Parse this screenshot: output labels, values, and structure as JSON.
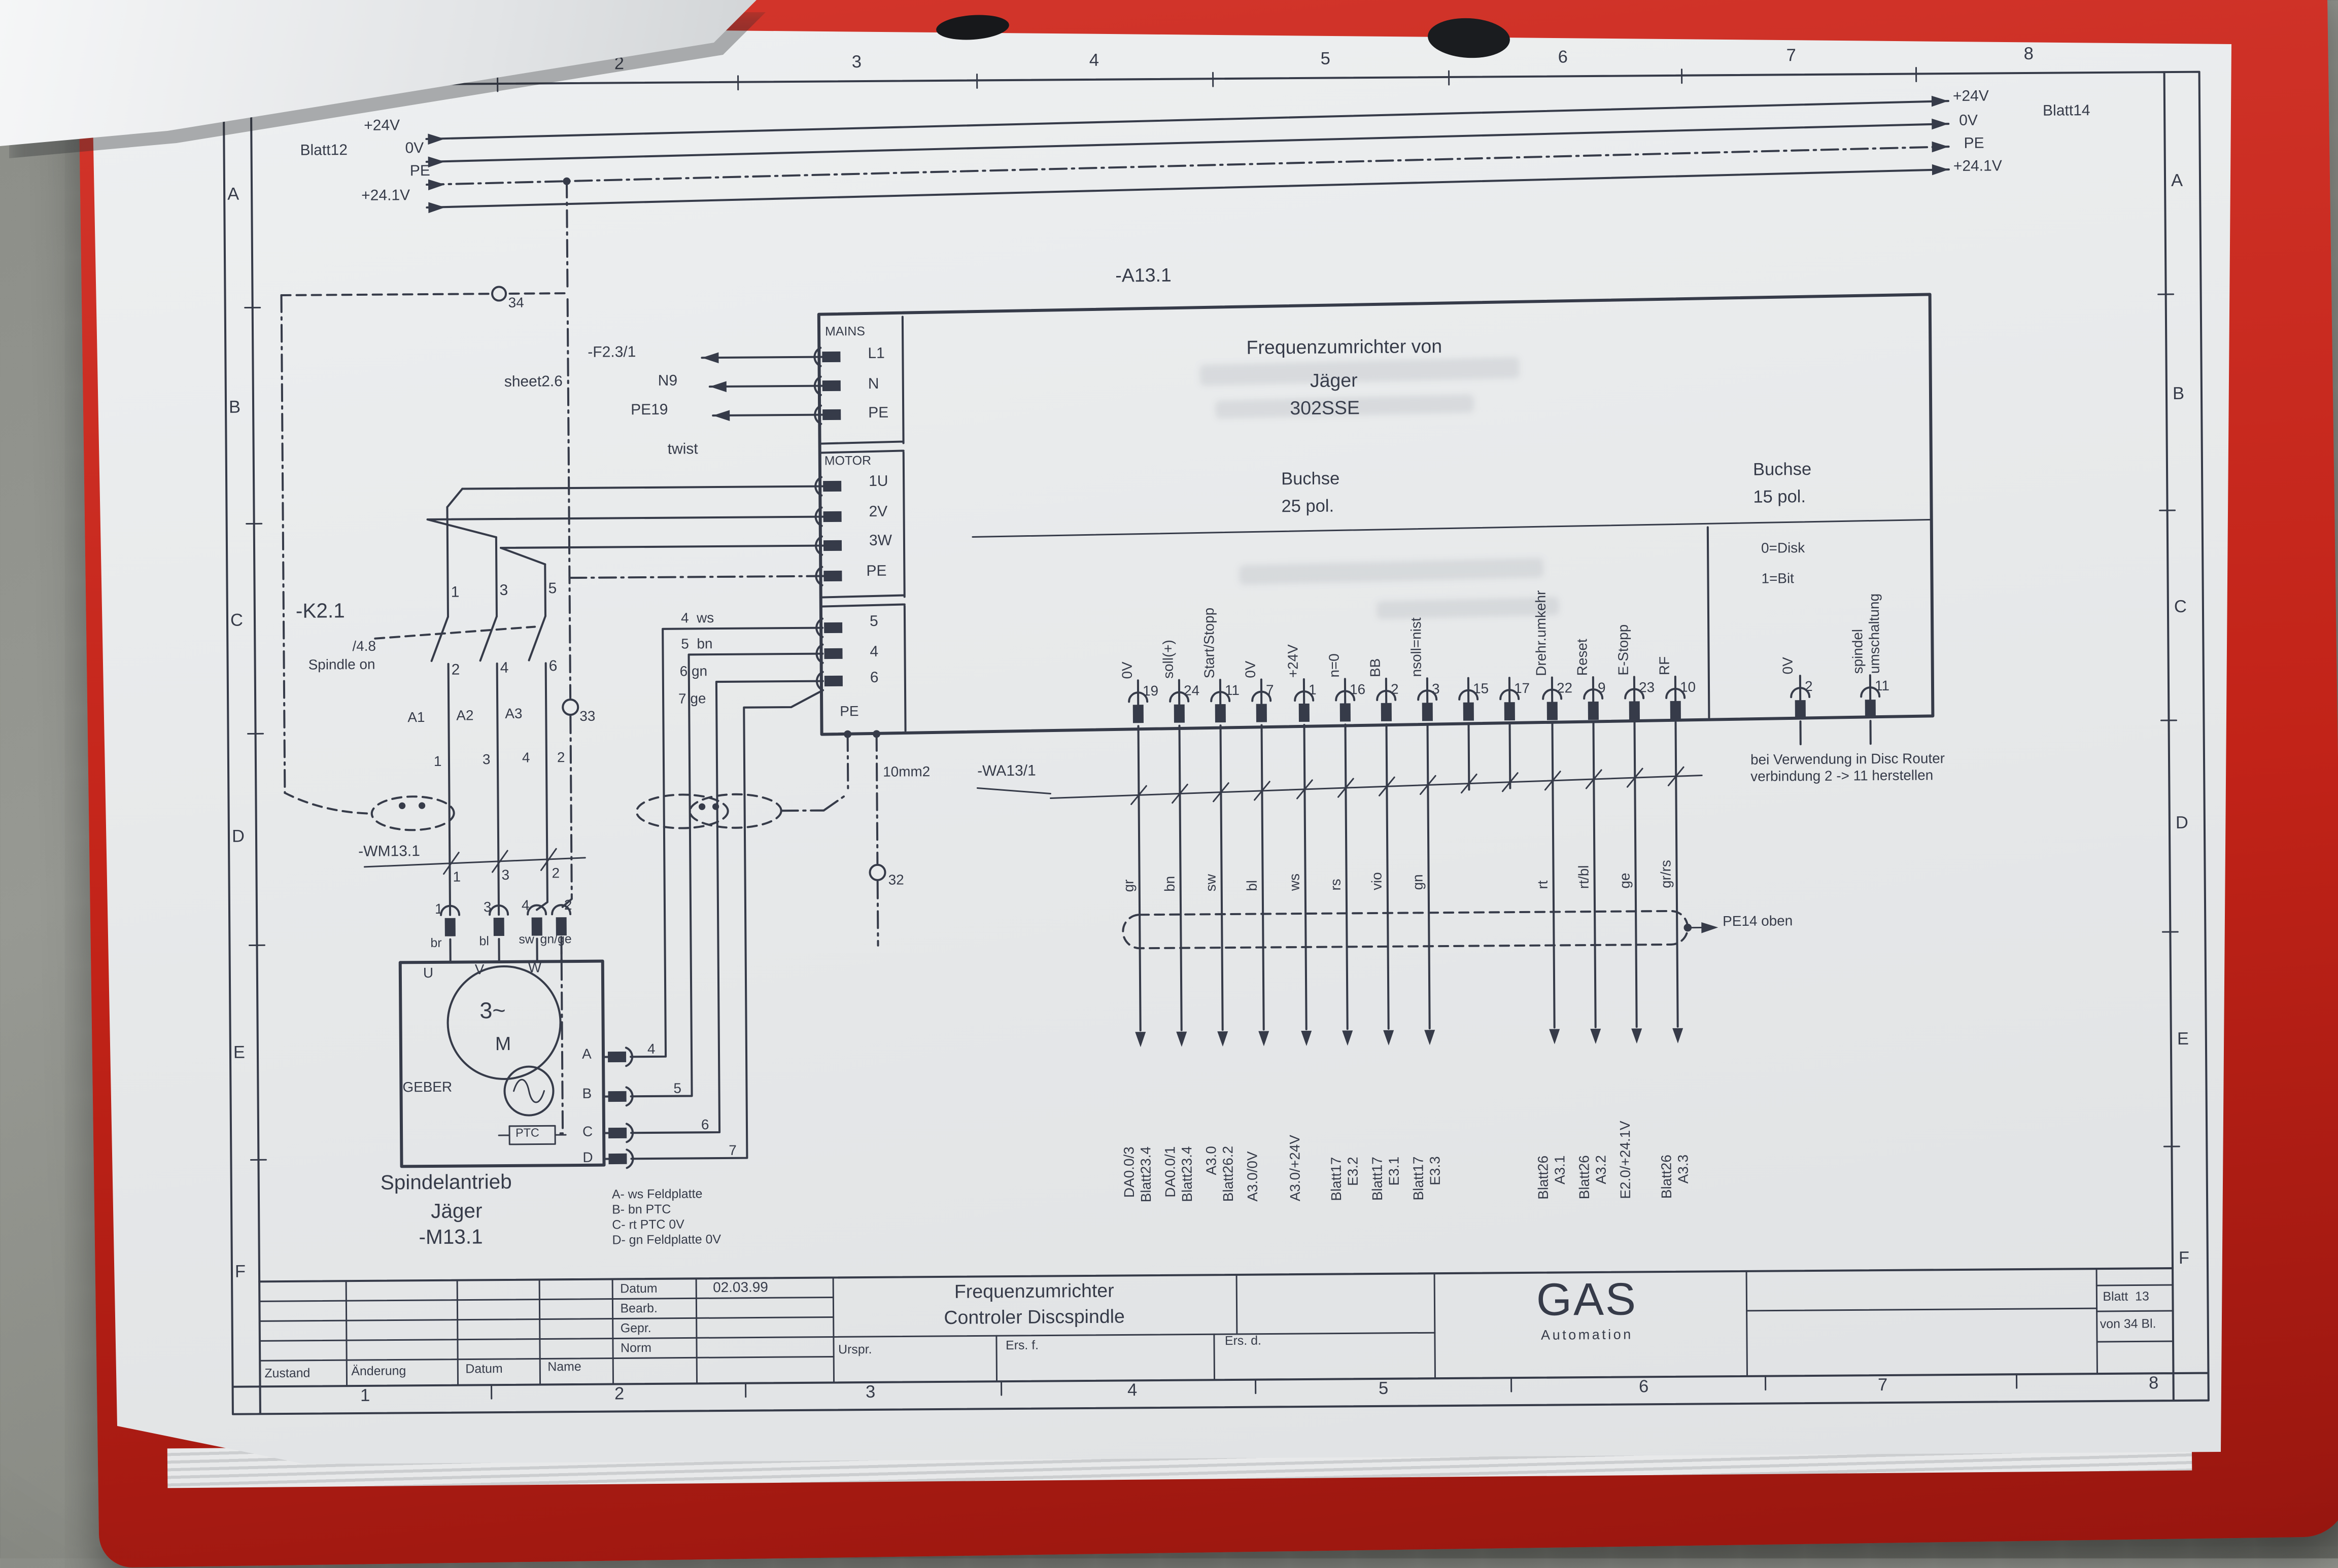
{
  "refs": {
    "left": "Blatt12",
    "right": "Blatt14",
    "rails": [
      "+24V",
      "0V",
      "PE",
      "+24.1V"
    ]
  },
  "incoming": {
    "fuse": "-F2.3/1",
    "sheet": "sheet2.6",
    "n": "N9",
    "pe": "PE19",
    "twist": "twist"
  },
  "device": {
    "tag": "-A13.1",
    "title1": "Frequenzumrichter von",
    "title2": "Jäger",
    "title3": "302SSE",
    "mains": "MAINS",
    "mains_pins": [
      "L1",
      "N",
      "PE"
    ],
    "motor": "MOTOR",
    "motor_pins": [
      "1U",
      "2V",
      "3W",
      "PE"
    ],
    "geber_pins": [
      "5",
      "4",
      "6"
    ],
    "pe": "PE",
    "con25_1": "Buchse",
    "con25_2": "25 pol.",
    "con15_1": "Buchse",
    "con15_2": "15 pol.",
    "disk": "0=Disk",
    "bit": "1=Bit"
  },
  "pins25": [
    {
      "pin": "19",
      "signal": "0V",
      "wire": "gr",
      "dest": [
        "DA0.0/3",
        "Blatt23.4"
      ]
    },
    {
      "pin": "24",
      "signal": "soll(+)",
      "wire": "bn",
      "dest": [
        "DA0.0/1",
        "Blatt23.4"
      ]
    },
    {
      "pin": "11",
      "signal": "Start/Stopp",
      "wire": "sw",
      "dest": [
        "A3.0",
        "Blatt26.2"
      ]
    },
    {
      "pin": "7",
      "signal": "0V",
      "wire": "bl",
      "dest": [
        "A3.0/0V"
      ]
    },
    {
      "pin": "1",
      "signal": "+24V",
      "wire": "ws",
      "dest": [
        "A3.0/+24V"
      ]
    },
    {
      "pin": "16",
      "signal": "n=0",
      "wire": "rs",
      "dest": [
        "Blatt17",
        "E3.2"
      ]
    },
    {
      "pin": "2",
      "signal": "BB",
      "wire": "vio",
      "dest": [
        "Blatt17",
        "E3.1"
      ]
    },
    {
      "pin": "3",
      "signal": "nsoll=nist",
      "wire": "gn",
      "dest": [
        "Blatt17",
        "E3.3"
      ]
    },
    {
      "pin": "15"
    },
    {
      "pin": "17"
    },
    {
      "pin": "22",
      "signal": "Drehr.umkehr",
      "wire": "rt",
      "dest": [
        "Blatt26",
        "A3.1"
      ]
    },
    {
      "pin": "9",
      "signal": "Reset",
      "wire": "rt/bl",
      "dest": [
        "Blatt26",
        "A3.2"
      ]
    },
    {
      "pin": "23",
      "signal": "E-Stopp",
      "wire": "ge",
      "dest": [
        "E2.0/+24.1V"
      ]
    },
    {
      "pin": "10",
      "signal": "RF",
      "wire": "gr/rs",
      "dest": [
        "Blatt26",
        "A3.3"
      ]
    }
  ],
  "pins15": [
    {
      "pin": "2",
      "signal": [
        "0V"
      ]
    },
    {
      "pin": "11",
      "signal": [
        "spindel",
        "umschaltung"
      ]
    }
  ],
  "cable25": {
    "tag": "-WA13/1",
    "pe14": "PE14 oben",
    "note1": "bei Verwendung in Disc Router",
    "note2": "verbindung 2 -> 11 herstellen"
  },
  "contactor": {
    "tag": "-K2.1",
    "ref": "/4.8",
    "func": "Spindle on",
    "top": [
      "1",
      "3",
      "5"
    ],
    "bot": [
      "2",
      "4",
      "6"
    ],
    "coil": [
      "A1",
      "A2",
      "A3"
    ],
    "wires": [
      "1",
      "3",
      "4",
      "2"
    ],
    "m33": "33",
    "m34": "34",
    "m32": "32",
    "size": "10mm2"
  },
  "cablem": {
    "tag": "-WM13.1",
    "cores": [
      "1",
      "3",
      "2"
    ],
    "pins": [
      "1",
      "3",
      "4",
      "2"
    ],
    "colors": [
      "br",
      "bl",
      "sw",
      "gn/ge"
    ]
  },
  "motor": {
    "u": "U",
    "v": "V",
    "w": "W",
    "sym": "3~",
    "m": "M",
    "geber": "GEBER",
    "ptc": "PTC",
    "pins": [
      "A",
      "B",
      "C",
      "D"
    ],
    "wire_nums": [
      "4",
      "5",
      "6",
      "7"
    ],
    "wire_rows": [
      "4  ws",
      "5  bn",
      "6 gn",
      "7 ge"
    ],
    "name1": "Spindelantrieb",
    "name2": "Jäger",
    "name3": "-M13.1",
    "legend": [
      "A- ws Feldplatte",
      "B- bn PTC",
      "C- rt PTC 0V",
      "D- gn Feldplatte 0V"
    ]
  },
  "titleblock": {
    "datum_l": "Datum",
    "datum_v": "02.03.99",
    "bearb": "Bearb.",
    "gepr": "Gepr.",
    "norm": "Norm",
    "zustand": "Zustand",
    "aenderung": "Änderung",
    "datum2": "Datum",
    "name": "Name",
    "title1": "Frequenzumrichter",
    "title2": "Controler Discspindle",
    "urspr": "Urspr.",
    "ersf": "Ers. f.",
    "ersd": "Ers. d.",
    "logo": "GAS",
    "logo_sub": "Automation",
    "blatt": "Blatt  13",
    "von": "von 34 Bl."
  },
  "frame": {
    "letters": [
      "A",
      "B",
      "C",
      "D",
      "E",
      "F"
    ],
    "numbers": [
      "1",
      "2",
      "3",
      "4",
      "5",
      "6",
      "7",
      "8"
    ]
  }
}
